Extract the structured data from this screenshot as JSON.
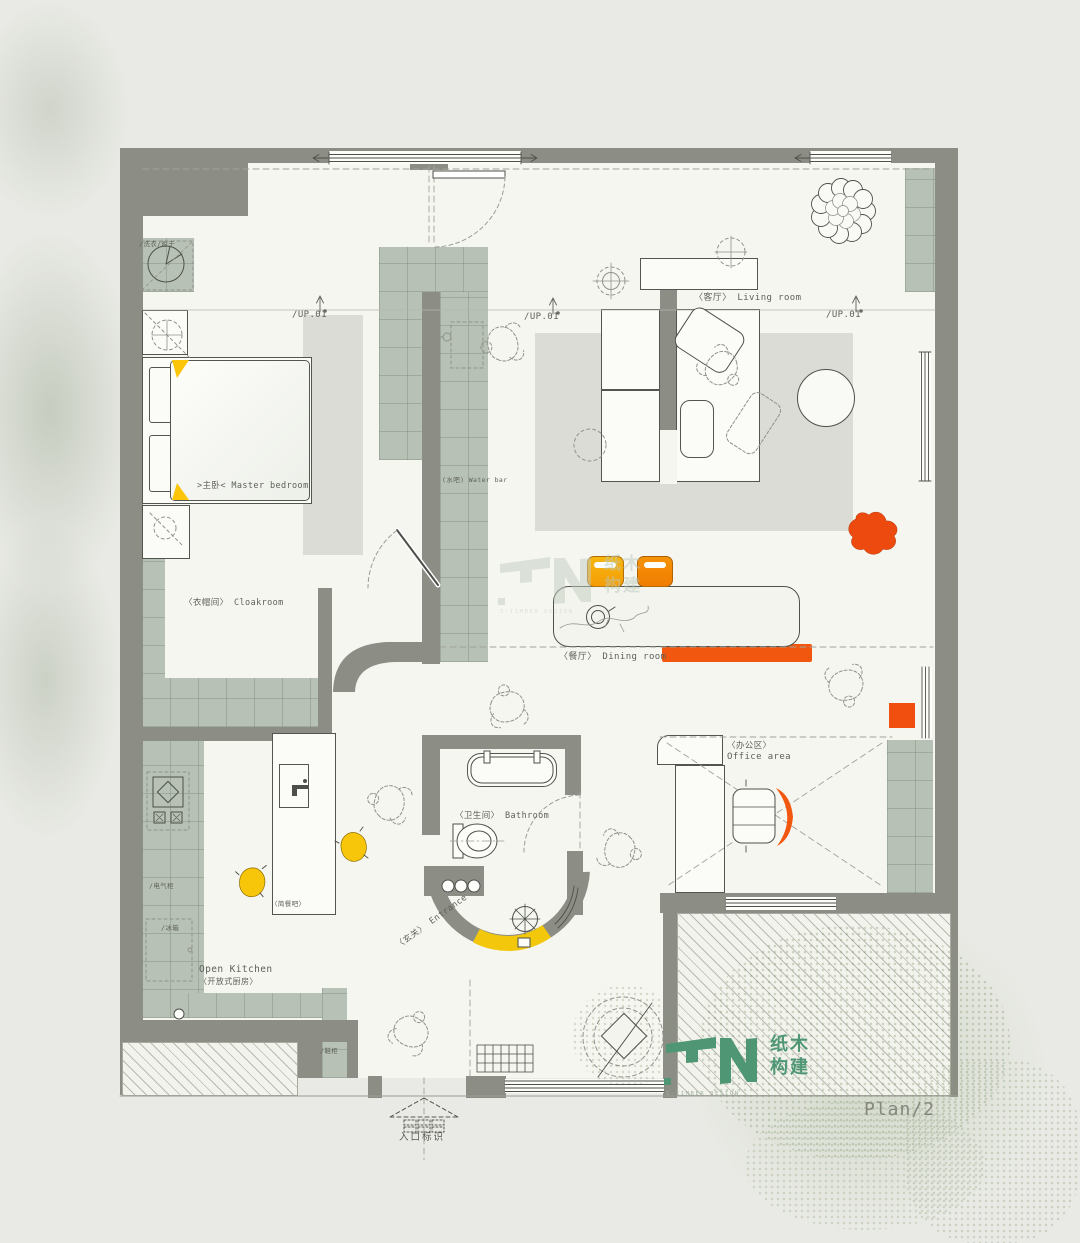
{
  "plan": {
    "sheet_label": "Plan/2",
    "entry_marker": "入口标识",
    "up_label": "/UP.01",
    "rooms": {
      "master_bedroom": ">主卧< Master bedroom",
      "living_room": "〈客厅〉 Living room",
      "dining_room": "〈餐厅〉 Dining room",
      "cloakroom": "〈衣帽间〉 Cloakroom",
      "bathroom": "〈卫生间〉 Bathroom",
      "office_area_zh": "〈办公区〉",
      "office_area_en": "Office area",
      "open_kitchen_en": "Open Kitchen",
      "open_kitchen_zh": "〈开放式厨房〉",
      "entrance": "〈玄关〉 Entrance",
      "water_bar": "(水吧) Water bar",
      "snack_bar": "〈简餐吧〉"
    },
    "fixtures": {
      "washer_dryer": "/洗衣/晾干",
      "electrical_cabinet": "/电气柜",
      "fridge": "/冰箱",
      "shoe_cabinet": "/鞋柜"
    }
  },
  "watermark": {
    "zh_line1": "纸木",
    "zh_line2": "构建",
    "caption": "S-TIMBER DESIGN"
  },
  "colors": {
    "wall": "#8c8e86",
    "cabinet": "#b8c1b5",
    "accent_orange": "#f2570f",
    "accent_yellow": "#f6c70a",
    "logo_green": "#4f9774"
  }
}
